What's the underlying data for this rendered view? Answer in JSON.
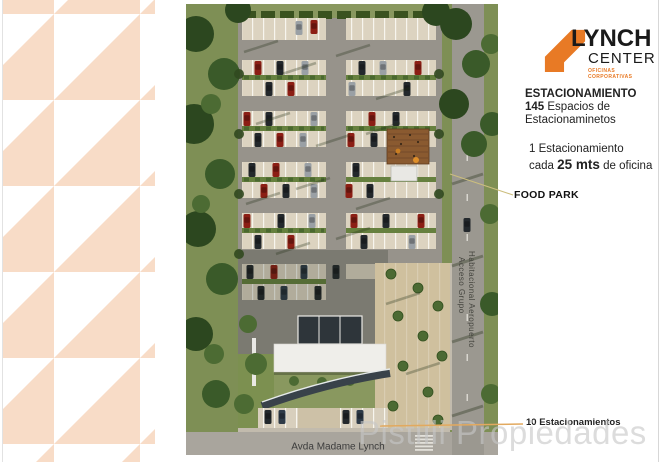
{
  "logo": {
    "title": "LYNCH",
    "subtitle": "CENTER",
    "tagline_line1": "OFICINAS",
    "tagline_line2": "CORPORATIVAS"
  },
  "info": {
    "heading": "ESTACIONAMIENTO",
    "spaces_number": "145",
    "spaces_text": " Espacios de",
    "spaces_text2": "Estacionaminetos",
    "ratio_line1": "1 Estacionamiento",
    "ratio_pre": "cada ",
    "ratio_bold": "25 mts",
    "ratio_post": " de oficina"
  },
  "callouts": {
    "food_park": "FOOD PARK",
    "bottom_spaces": "10 Estacionamientos"
  },
  "map": {
    "street_bottom": "Avda Madame Lynch",
    "street_side_line1": "Acceso Grupo",
    "street_side_line2": "Habitacional Aeropuerto"
  },
  "watermark": "Pistilli Propiedades",
  "colors": {
    "pattern": "#f8dcc7",
    "accent": "#e87a25",
    "food_park_line": "#ccbe7e",
    "callout_line": "#e2a95f"
  }
}
